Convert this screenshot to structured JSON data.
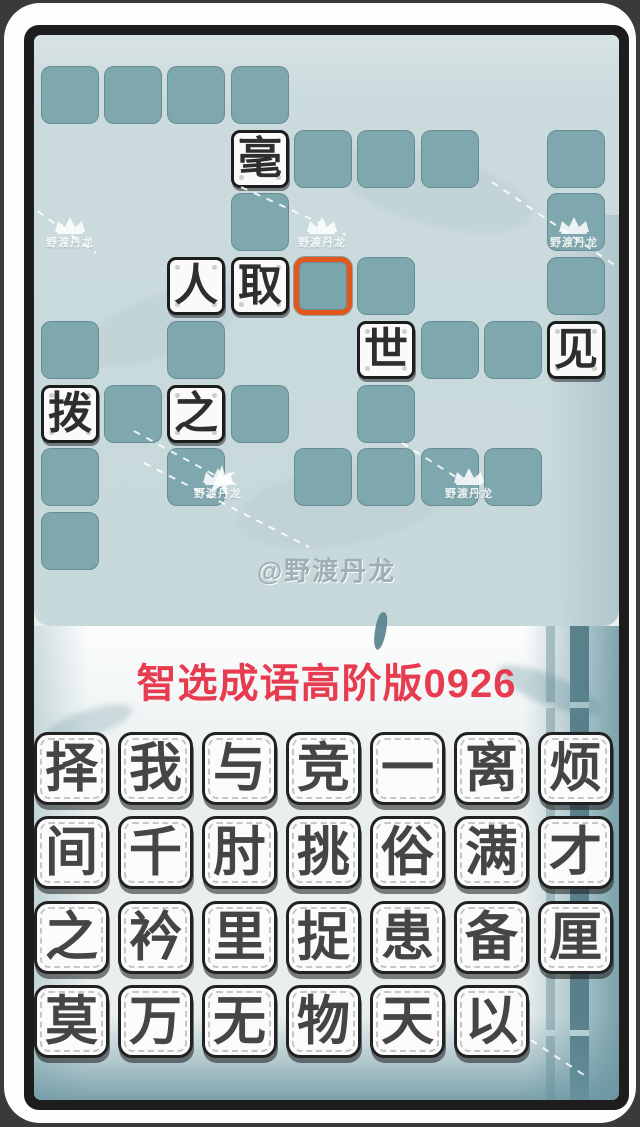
{
  "title": {
    "text": "智选成语高阶版0926",
    "color": "#e73b50"
  },
  "watermark": {
    "big_text": "@野渡丹龙",
    "small_text": "野渡丹龙"
  },
  "colors": {
    "board_panel": "#c9dadd",
    "empty_tile": "#7fa7ae",
    "selected_border": "#e2571c",
    "filled_tile_bg": "#fafafa",
    "frame": "#1d1d1d",
    "title_red": "#e73b50"
  },
  "board": {
    "grid": {
      "cols": 9,
      "rows": 8
    },
    "tiles": [
      {
        "row": 0,
        "col": 0,
        "state": "empty"
      },
      {
        "row": 0,
        "col": 1,
        "state": "empty"
      },
      {
        "row": 0,
        "col": 2,
        "state": "empty"
      },
      {
        "row": 0,
        "col": 3,
        "state": "empty"
      },
      {
        "row": 1,
        "col": 3,
        "state": "filled",
        "char": "毫"
      },
      {
        "row": 1,
        "col": 4,
        "state": "empty"
      },
      {
        "row": 1,
        "col": 5,
        "state": "empty"
      },
      {
        "row": 1,
        "col": 6,
        "state": "empty"
      },
      {
        "row": 1,
        "col": 8,
        "state": "empty"
      },
      {
        "row": 2,
        "col": 3,
        "state": "empty"
      },
      {
        "row": 2,
        "col": 8,
        "state": "empty"
      },
      {
        "row": 3,
        "col": 2,
        "state": "filled",
        "char": "人"
      },
      {
        "row": 3,
        "col": 3,
        "state": "filled",
        "char": "取"
      },
      {
        "row": 3,
        "col": 4,
        "state": "selected"
      },
      {
        "row": 3,
        "col": 5,
        "state": "empty"
      },
      {
        "row": 3,
        "col": 8,
        "state": "empty"
      },
      {
        "row": 4,
        "col": 0,
        "state": "empty"
      },
      {
        "row": 4,
        "col": 2,
        "state": "empty"
      },
      {
        "row": 4,
        "col": 5,
        "state": "filled",
        "char": "世"
      },
      {
        "row": 4,
        "col": 6,
        "state": "empty"
      },
      {
        "row": 4,
        "col": 7,
        "state": "empty"
      },
      {
        "row": 4,
        "col": 8,
        "state": "filled",
        "char": "见"
      },
      {
        "row": 5,
        "col": 0,
        "state": "filled",
        "char": "拨"
      },
      {
        "row": 5,
        "col": 1,
        "state": "empty"
      },
      {
        "row": 5,
        "col": 2,
        "state": "filled",
        "char": "之"
      },
      {
        "row": 5,
        "col": 3,
        "state": "empty"
      },
      {
        "row": 5,
        "col": 5,
        "state": "empty"
      },
      {
        "row": 6,
        "col": 0,
        "state": "empty"
      },
      {
        "row": 6,
        "col": 2,
        "state": "empty"
      },
      {
        "row": 6,
        "col": 4,
        "state": "empty"
      },
      {
        "row": 6,
        "col": 5,
        "state": "empty"
      },
      {
        "row": 6,
        "col": 6,
        "state": "empty"
      },
      {
        "row": 6,
        "col": 7,
        "state": "empty"
      },
      {
        "row": 7,
        "col": 0,
        "state": "empty"
      }
    ]
  },
  "bank": {
    "rows": [
      [
        "择",
        "我",
        "与",
        "竞",
        "一",
        "离",
        "烦"
      ],
      [
        "间",
        "千",
        "肘",
        "挑",
        "俗",
        "满",
        "才"
      ],
      [
        "之",
        "衿",
        "里",
        "捉",
        "患",
        "备",
        "厘"
      ],
      [
        "莫",
        "万",
        "无",
        "物",
        "天",
        "以"
      ]
    ]
  }
}
